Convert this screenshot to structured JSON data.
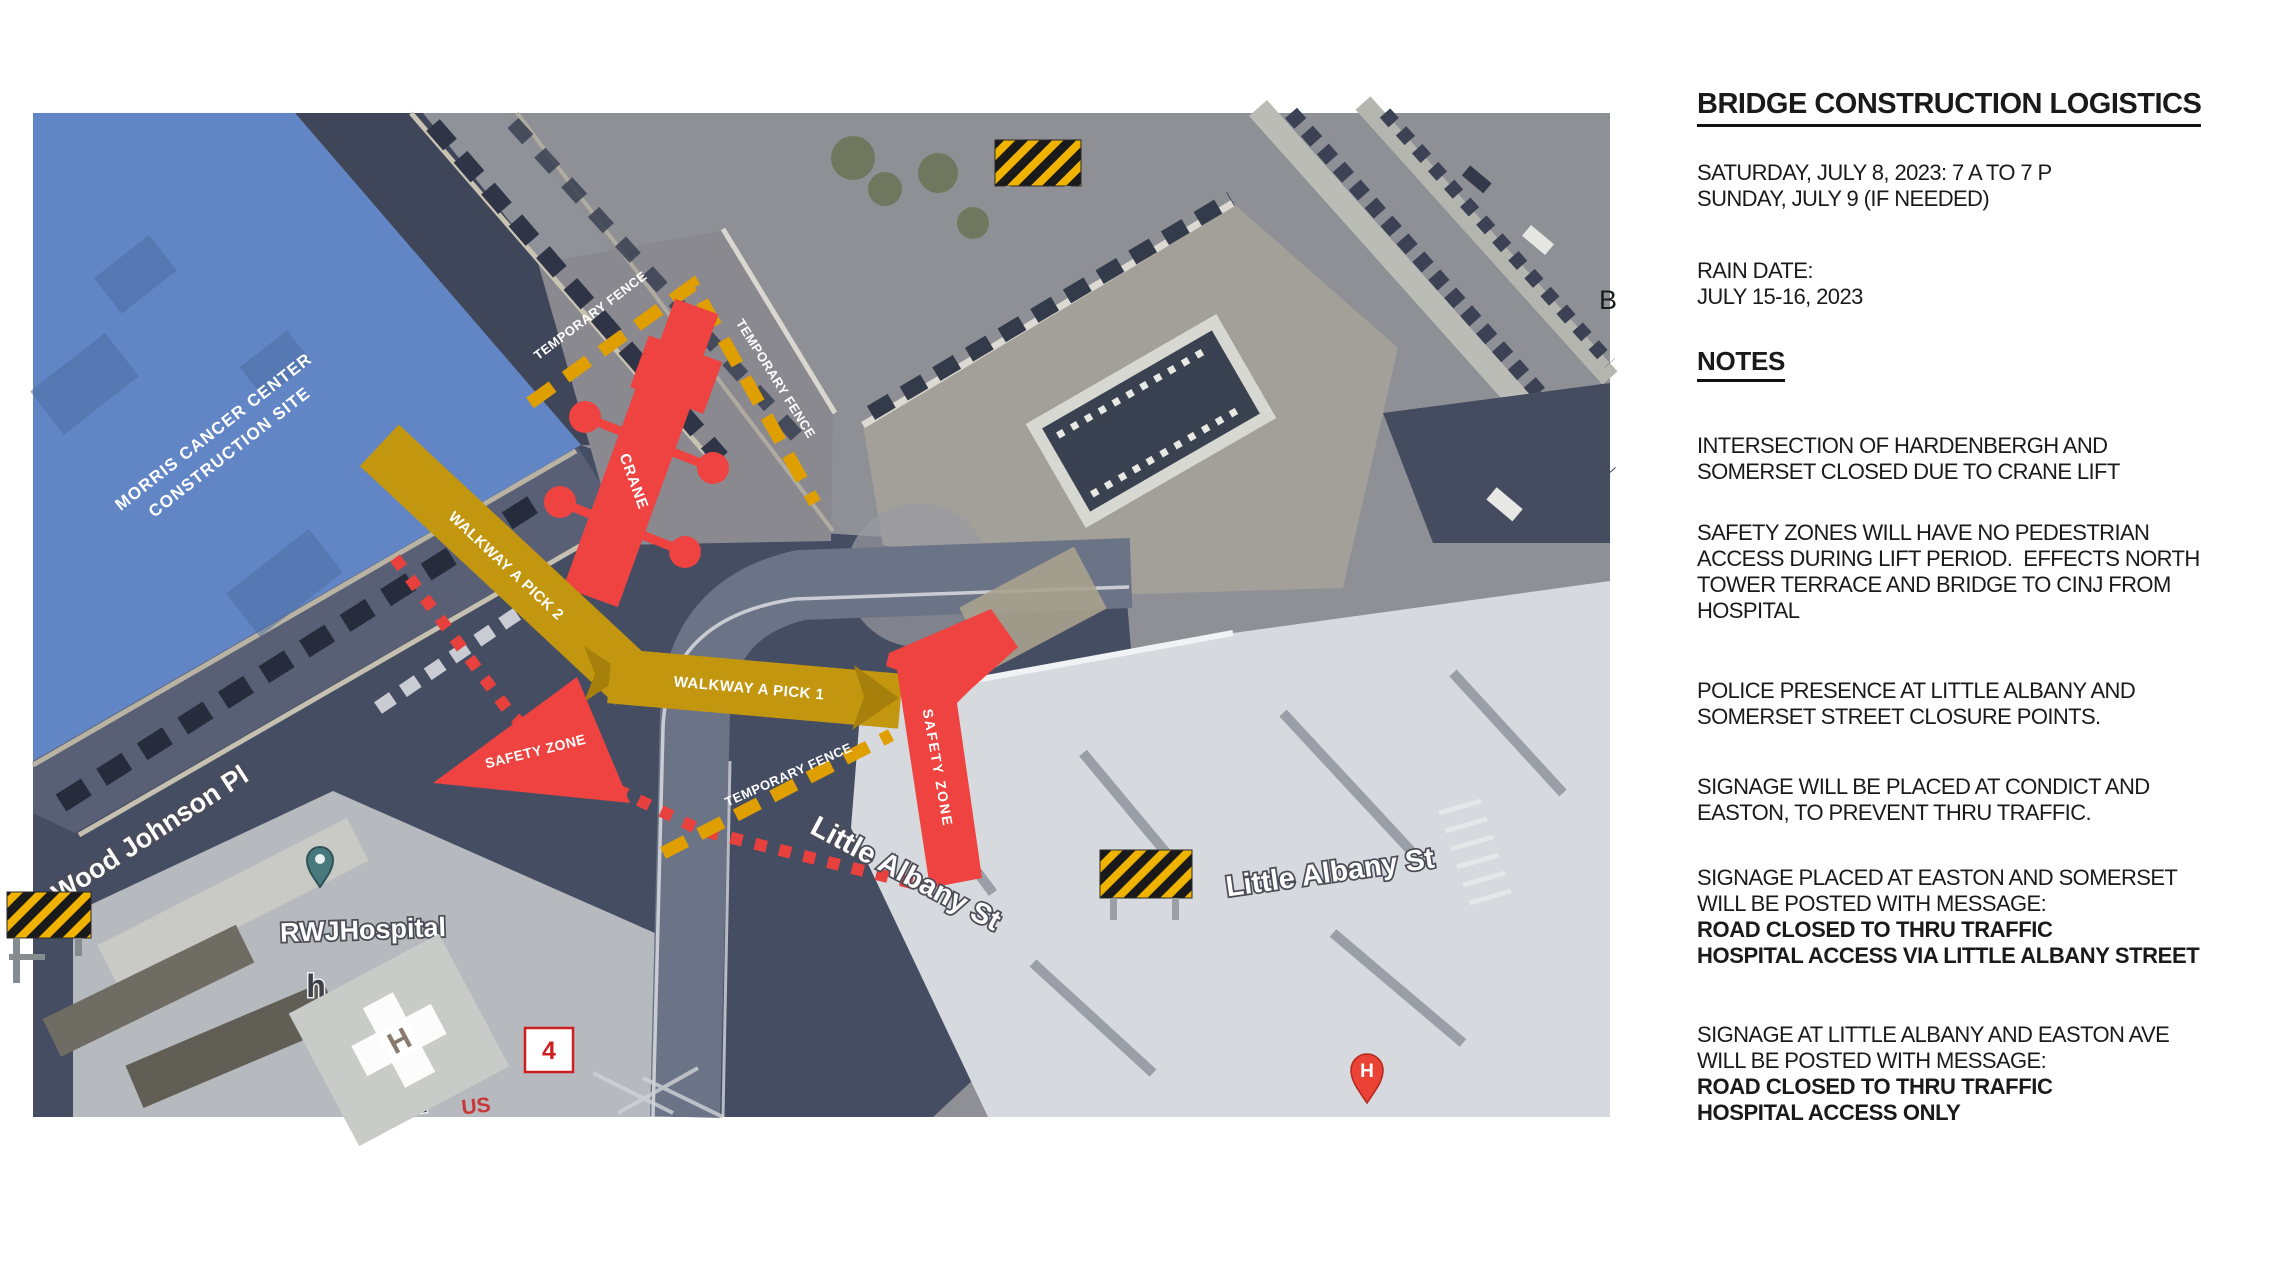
{
  "panel": {
    "title": "BRIDGE CONSTRUCTION LOGISTICS",
    "schedule": [
      "SATURDAY, JULY 8, 2023: 7 A TO 7 P",
      "SUNDAY, JULY 9 (IF NEEDED)"
    ],
    "rain": [
      "RAIN DATE:",
      "JULY 15-16, 2023"
    ],
    "notes_heading": "NOTES",
    "note1": [
      "INTERSECTION OF HARDENBERGH AND",
      "SOMERSET CLOSED DUE TO CRANE LIFT"
    ],
    "note2": [
      "SAFETY ZONES WILL HAVE NO PEDESTRIAN",
      "ACCESS DURING LIFT PERIOD.  EFFECTS NORTH",
      "TOWER TERRACE AND BRIDGE TO CINJ FROM",
      "HOSPITAL"
    ],
    "note3": [
      "POLICE PRESENCE AT LITTLE ALBANY AND",
      "SOMERSET STREET CLOSURE POINTS."
    ],
    "note4": [
      "SIGNAGE WILL BE PLACED AT CONDICT AND",
      "EASTON, TO PREVENT THRU TRAFFIC."
    ],
    "note5": [
      "SIGNAGE PLACED AT EASTON AND SOMERSET",
      "WILL BE POSTED WITH MESSAGE:",
      "ROAD CLOSED TO THRU TRAFFIC",
      "HOSPITAL ACCESS VIA LITTLE ALBANY STREET"
    ],
    "note6": [
      "SIGNAGE AT LITTLE ALBANY AND EASTON AVE",
      "WILL BE POSTED WITH MESSAGE:",
      "ROAD CLOSED TO THRU TRAFFIC",
      "HOSPITAL ACCESS ONLY"
    ]
  },
  "map": {
    "construction_site": [
      "MORRIS CANCER CENTER",
      "CONSTRUCTION SITE"
    ],
    "temporary_fence_label": "TEMPORARY FENCE",
    "crane_label": "CRANE",
    "walkway_pick2_label": "WALKWAY A PICK 2",
    "walkway_pick1_label": "WALKWAY A PICK 1",
    "safety_zone_label": "SAFETY ZONE",
    "streets": {
      "wood_johnson": "Wood Johnson Pl",
      "little_albany": "Little Albany St"
    },
    "places": {
      "hospital": "RWJHospital",
      "hospital_pin": "H",
      "helipad": "H",
      "marker_4": "4",
      "address_172": "172",
      "us_label": "US",
      "partial_label": "h",
      "edge_glyph": "B"
    },
    "colors": {
      "overlay_blue": "#6286c5",
      "zone_red": "#ee4340",
      "walkway_gold": "#c3960f",
      "walkway_arrow_gold": "#a6800b",
      "fence_orange": "#e09f00",
      "hazard_yellow": "#f0b400"
    }
  }
}
